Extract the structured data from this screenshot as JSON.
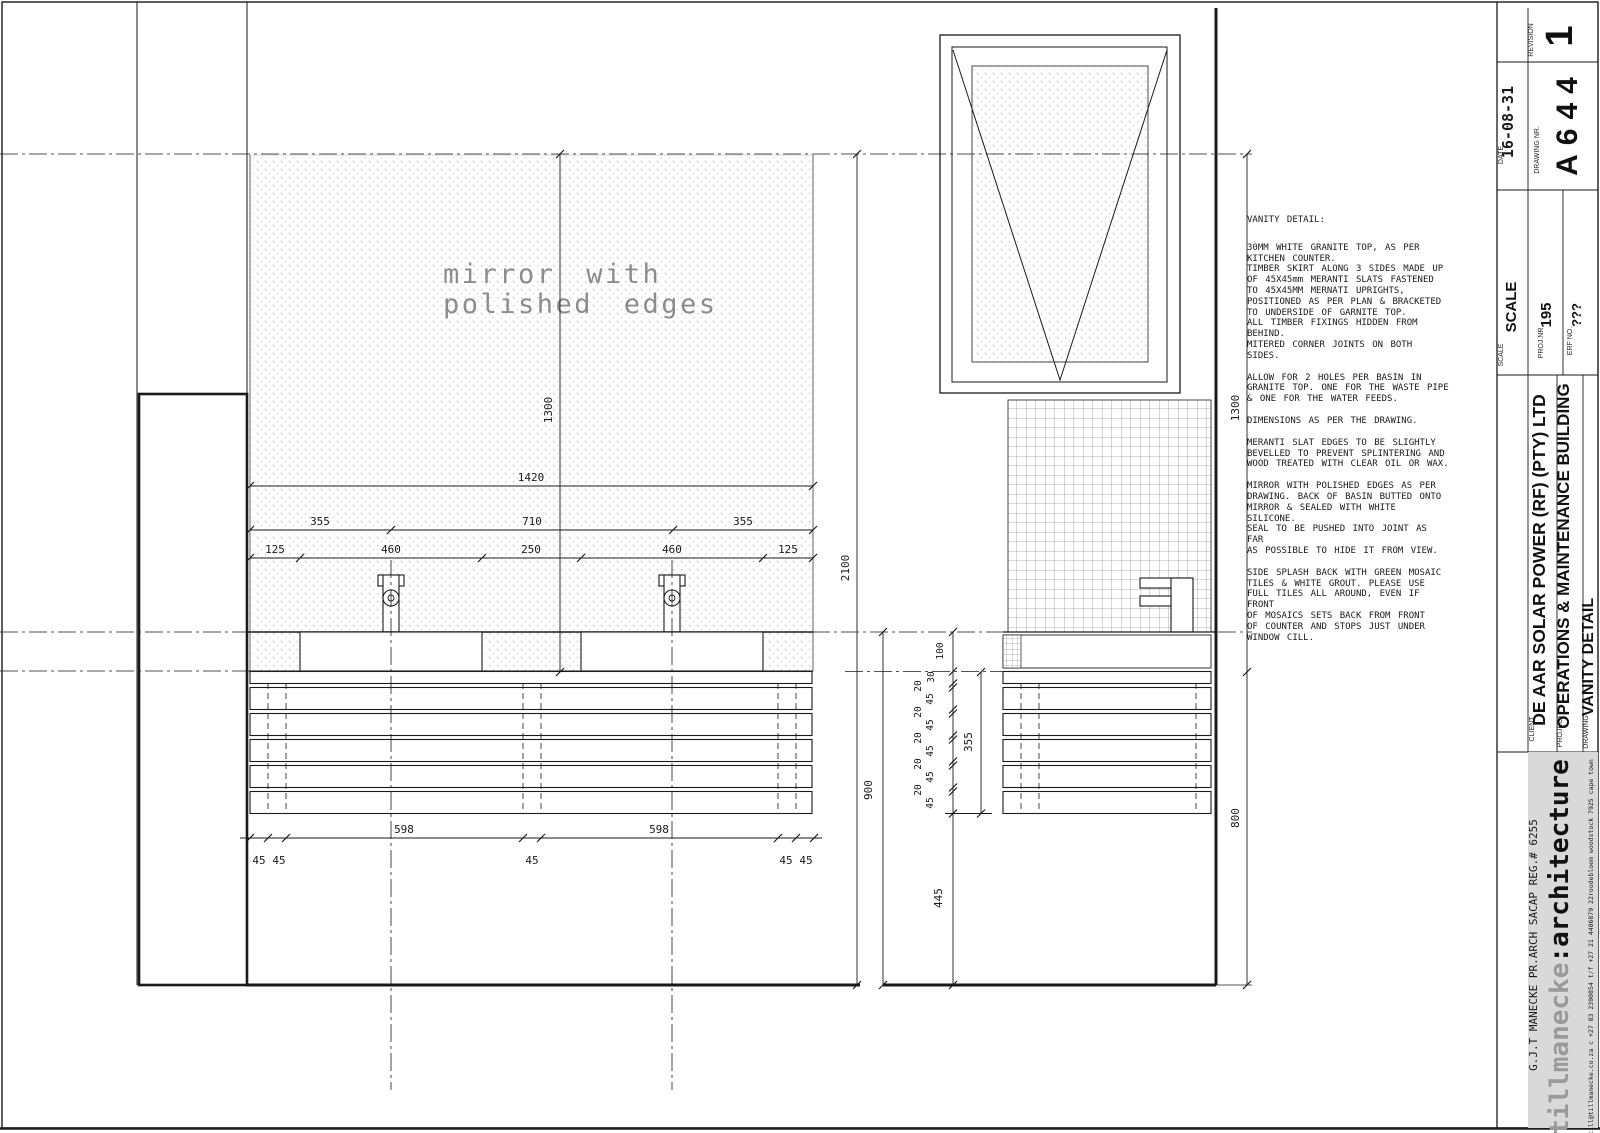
{
  "sheet": {
    "revision_label": "REVISION",
    "revision": "1",
    "date_label": "DATE",
    "date": "16-08-31",
    "drawing_nr_label": "DRAWING NR.",
    "drawing_nr": "A644",
    "scale_label": "SCALE",
    "scale_value": "SCALE",
    "proj_label": "PROJ.NR.",
    "proj_value": "195",
    "erf_label": "ERF NO.",
    "erf_value": "???",
    "client_label": "CLIENT",
    "client": "DE AAR SOLAR POWER (RF) (PTY) LTD",
    "project_label": "PROJECT",
    "project": "OPERATIONS & MAINTENANCE BUILDING",
    "drawing_label": "DRAWING",
    "drawing_title": "VANITY DETAIL",
    "architect_reg": "G.J.T MANECKE PR.ARCH SACAP REG.# 6255",
    "brand_gray": "tillmanecke",
    "brand_black": ":architecture",
    "contact": "till@tillmanecke.co.za   c +27 83 2390854   t/f +27 21 4486879   22roodebloem woodstock 7925 cape town"
  },
  "labels": {
    "mirror_line1": "mirror with",
    "mirror_line2": "polished edges"
  },
  "dims": {
    "front": {
      "height": "1300",
      "width": "1420",
      "row2": [
        "355",
        "710",
        "355"
      ],
      "row3": [
        "125",
        "460",
        "250",
        "460",
        "125"
      ],
      "bottom598": [
        "598",
        "598"
      ],
      "bottom45": [
        "45",
        "45",
        "45",
        "45",
        "45"
      ],
      "total_height": "2100"
    },
    "side": {
      "counter_height": "900",
      "plinth": "445",
      "skirt": "355",
      "counter": "100",
      "top": "30",
      "gaps": [
        "20",
        "20",
        "20",
        "20",
        "20"
      ],
      "slats": [
        "45",
        "45",
        "45",
        "45",
        "45"
      ],
      "wall_height": "1300",
      "below": "800"
    }
  },
  "notes": {
    "p0": "VANITY DETAIL:",
    "p1": "30MM WHITE GRANITE TOP, AS PER\nKITCHEN COUNTER.\nTIMBER SKIRT ALONG 3 SIDES MADE UP\nOF 45X45mm MERANTI SLATS FASTENED\nTO 45X45MM MERNATI UPRIGHTS,\nPOSITIONED AS PER PLAN & BRACKETED\nTO UNDERSIDE OF GARNITE TOP.\nALL TIMBER FIXINGS HIDDEN FROM\nBEHIND.\nMITERED CORNER JOINTS ON BOTH\nSIDES.",
    "p2": "ALLOW FOR 2 HOLES PER BASIN IN\nGRANITE TOP. ONE FOR THE WASTE PIPE\n& ONE FOR THE WATER FEEDS.",
    "p3": "DIMENSIONS AS PER THE DRAWING.",
    "p4": "MERANTI SLAT EDGES TO BE SLIGHTLY\nBEVELLED TO PREVENT SPLINTERING AND\nWOOD TREATED WITH CLEAR OIL OR WAX.",
    "p5": "MIRROR WITH POLISHED EDGES AS PER\nDRAWING. BACK OF BASIN BUTTED ONTO\nMIRROR & SEALED WITH WHITE SILICONE.\nSEAL TO BE PUSHED INTO JOINT AS FAR\nAS POSSIBLE TO HIDE IT FROM VIEW.",
    "p6": "SIDE SPLASH BACK WITH GREEN MOSAIC\nTILES & WHITE GROUT. PLEASE USE\nFULL TILES ALL AROUND, EVEN IF FRONT\nOF MOSAICS SETS BACK FROM FRONT\nOF COUNTER AND STOPS JUST UNDER\nWINDOW CILL."
  }
}
